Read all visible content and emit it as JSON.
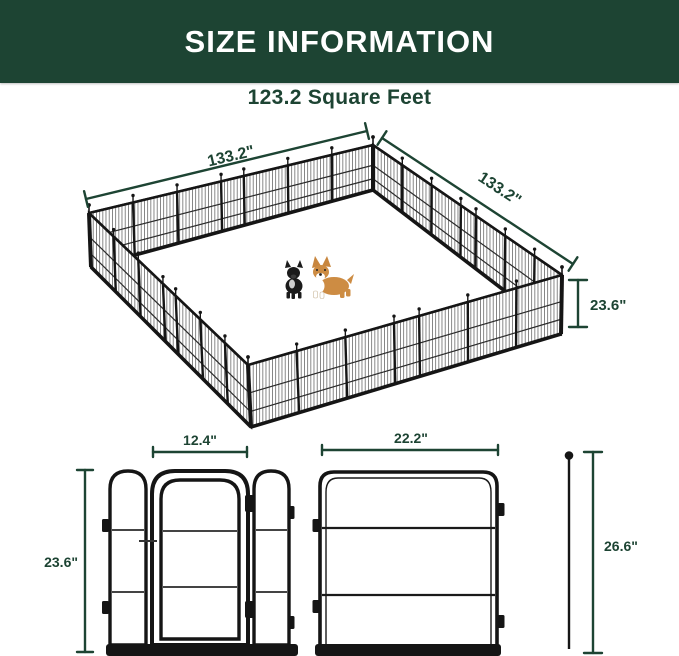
{
  "header": {
    "title": "SIZE INFORMATION"
  },
  "area": {
    "label": "123.2 Square Feet"
  },
  "pen": {
    "width_label": "133.2\"",
    "depth_label": "133.2\"",
    "height_label": "23.6\""
  },
  "panels": {
    "gate_width_label": "12.4\"",
    "gate_height_label": "23.6\"",
    "panel_width_label": "22.2\"",
    "stake_height_label": "26.6\""
  },
  "icons": {
    "dogs": [
      "french-bulldog",
      "corgi"
    ],
    "stake": "ground-stake"
  },
  "colors": {
    "header_bg": "#1d4433",
    "accent": "#1d4433",
    "fence": "#151515",
    "corgi_coat": "#cd8c43",
    "background": "#ffffff"
  }
}
